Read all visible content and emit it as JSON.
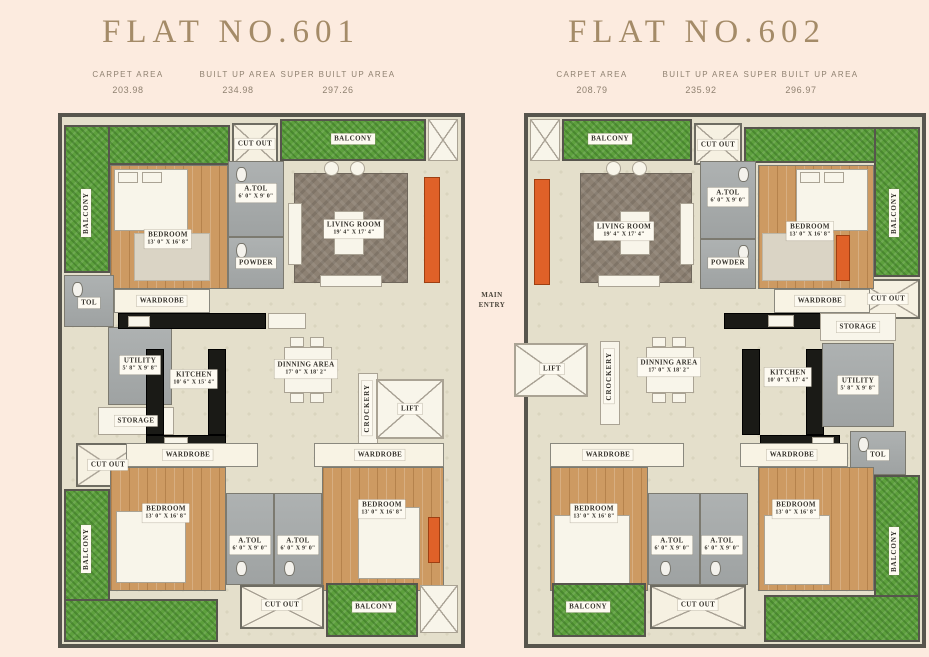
{
  "flats": [
    {
      "title": "FLAT NO.601",
      "stats": [
        {
          "label": "CARPET AREA",
          "value": "203.98"
        },
        {
          "label": "BUILT UP AREA",
          "value": "234.98"
        },
        {
          "label": "SUPER BUILT UP AREA",
          "value": "297.26"
        }
      ],
      "rooms": {
        "balcony_top_left": "BALCONY",
        "balcony_top": "BALCONY",
        "cut_out_top": "CUT OUT",
        "bedroom1": {
          "name": "BEDROOM",
          "dim": "13' 0\" X 16' 8\""
        },
        "atol1": {
          "name": "A.TOL",
          "dim": "6' 0\" X 9' 0\""
        },
        "powder": "POWDER",
        "living": {
          "name": "LIVING ROOM",
          "dim": "19' 4\" X 17' 4\""
        },
        "wardrobe1": "WARDROBE",
        "tol": "TOL",
        "utility": {
          "name": "UTILITY",
          "dim": "5' 8\" X 9' 8\""
        },
        "kitchen": {
          "name": "KITCHEN",
          "dim": "10' 6\" X 15' 4\""
        },
        "storage": "STORAGE",
        "cut_out_left": "CUT OUT",
        "dinning": {
          "name": "DINNING AREA",
          "dim": "17' 0\" X 18' 2\""
        },
        "crockery": "CROCKERY",
        "lift": "LIFT",
        "wardrobe2": "WARDROBE",
        "wardrobe3": "WARDROBE",
        "bedroom2": {
          "name": "BEDROOM",
          "dim": "13' 0\" X 16' 8\""
        },
        "bedroom3": {
          "name": "BEDROOM",
          "dim": "13' 0\" X 16' 8\""
        },
        "atol2": {
          "name": "A.TOL",
          "dim": "6' 0\" X 9' 0\""
        },
        "atol3": {
          "name": "A.TOL",
          "dim": "6' 0\" X 9' 0\""
        },
        "balcony_bottom_left": "BALCONY",
        "cut_out_bottom": "CUT OUT",
        "balcony_bottom": "BALCONY"
      }
    },
    {
      "title": "FLAT NO.602",
      "stats": [
        {
          "label": "CARPET AREA",
          "value": "208.79"
        },
        {
          "label": "BUILT UP AREA",
          "value": "235.92"
        },
        {
          "label": "SUPER BUILT UP AREA",
          "value": "296.97"
        }
      ],
      "rooms": {
        "balcony_top": "BALCONY",
        "cut_out_top": "CUT OUT",
        "balcony_top_right": "BALCONY",
        "cut_out_right": "CUT OUT",
        "living": {
          "name": "LIVING ROOM",
          "dim": "19' 4\" X 17' 4\""
        },
        "atol1": {
          "name": "A.TOL",
          "dim": "6' 0\" X 9' 0\""
        },
        "powder": "POWDER",
        "bedroom1": {
          "name": "BEDROOM",
          "dim": "13' 0\" X 16' 8\""
        },
        "wardrobe1": "WARDROBE",
        "main_entry": "MAIN ENTRY",
        "lift": "LIFT",
        "crockery": "CROCKERY",
        "dinning": {
          "name": "DINNING AREA",
          "dim": "17' 0\" X 18' 2\""
        },
        "kitchen": {
          "name": "KITCHEN",
          "dim": "10' 0\" X 17' 4\""
        },
        "storage": "STORAGE",
        "utility": {
          "name": "UTILITY",
          "dim": "5' 8\" X 9' 8\""
        },
        "tol": "TOL",
        "wardrobe2": "WARDROBE",
        "wardrobe3": "WARDROBE",
        "bedroom2": {
          "name": "BEDROOM",
          "dim": "13' 0\" X 16' 8\""
        },
        "atol2": {
          "name": "A.TOL",
          "dim": "6' 0\" X 9' 0\""
        },
        "atol3": {
          "name": "A.TOL",
          "dim": "6' 0\" X 9' 0\""
        },
        "bedroom3": {
          "name": "BEDROOM",
          "dim": "13' 0\" X 16' 8\""
        },
        "balcony_bottom": "BALCONY",
        "cut_out_bottom": "CUT OUT",
        "balcony_bottom_right": "BALCONY"
      }
    }
  ]
}
